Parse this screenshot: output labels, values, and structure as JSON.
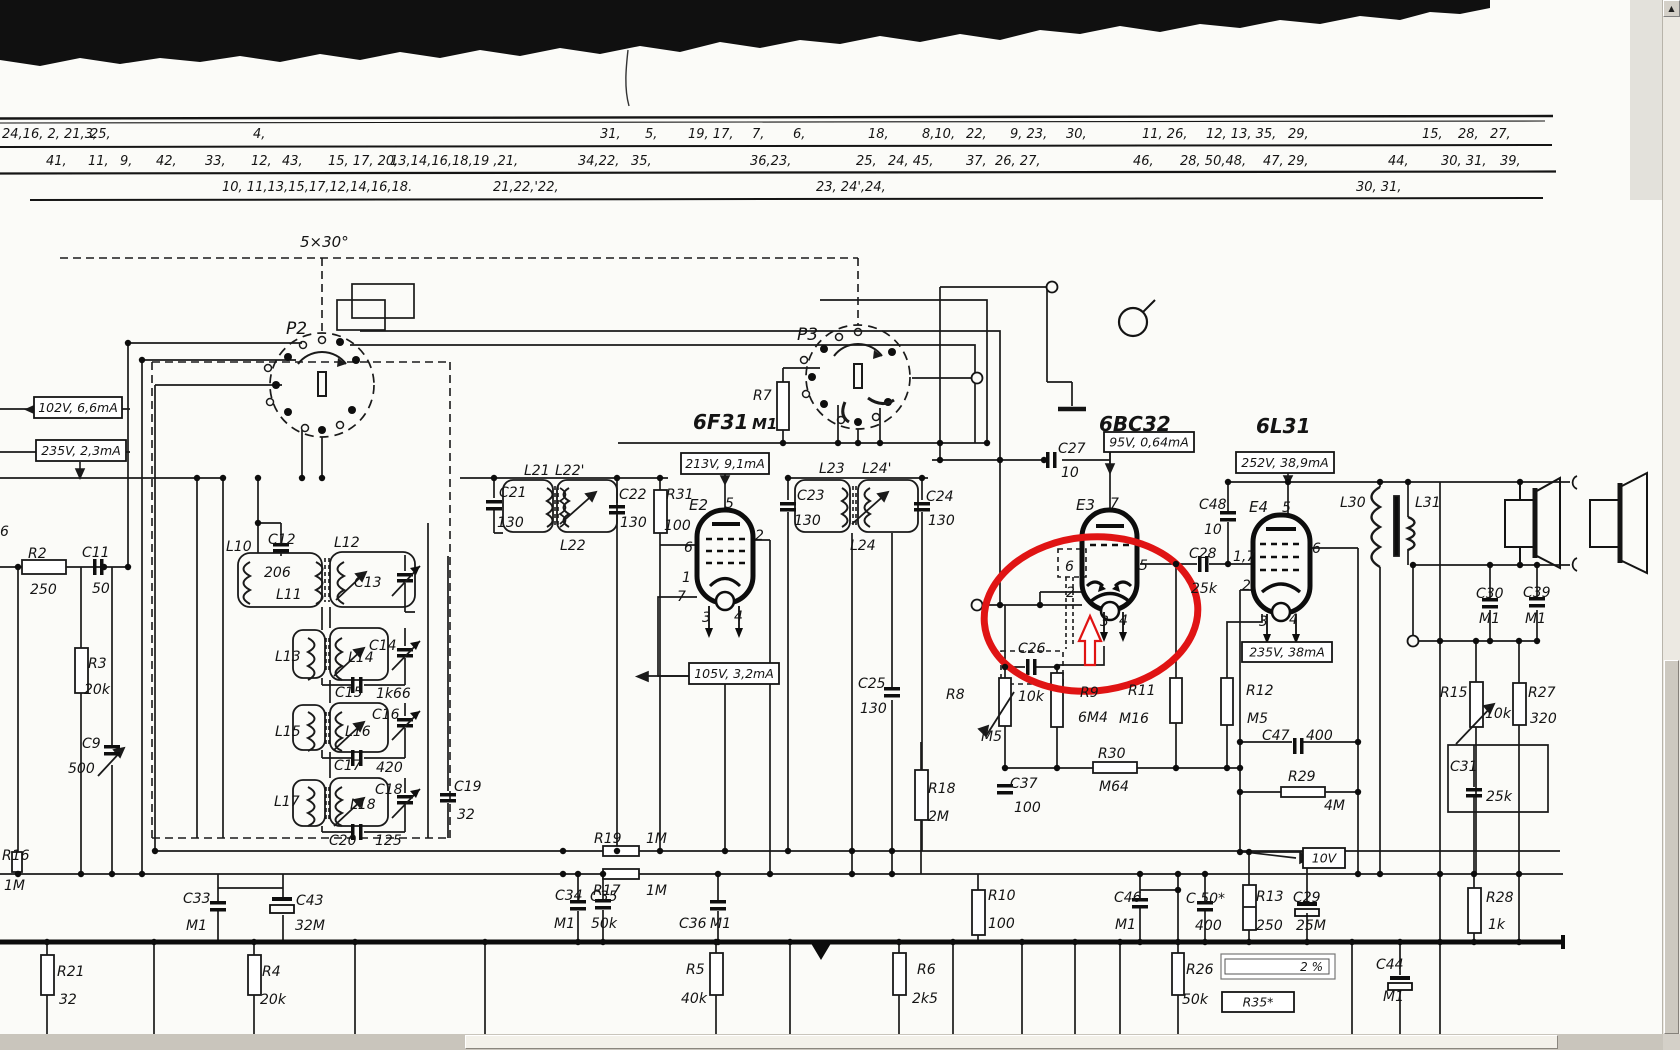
{
  "viewer": {
    "scroll_up_icon": "▲",
    "percent_field": {
      "value": "2 %"
    }
  },
  "annotation": {
    "highlight_color": "#e01414",
    "shapes": [
      "ellipse-around-6BC32-cathode",
      "arrow-up-below-tube"
    ]
  },
  "schematic": {
    "headings": [
      [
        "6F31",
        693,
        429,
        20
      ],
      [
        "M1",
        752,
        429,
        15
      ],
      [
        "6BC32",
        1099,
        431,
        20
      ],
      [
        "6L31",
        1256,
        433,
        20
      ]
    ],
    "boxed_values": [
      [
        "102V, 6,6mA",
        34,
        397,
        88,
        21,
        "v"
      ],
      [
        "235V, 2,3mA",
        36,
        440,
        90,
        21,
        "v"
      ],
      [
        "213V, 9,1mA",
        681,
        453,
        88,
        21,
        "v"
      ],
      [
        "105V, 3,2mA",
        689,
        663,
        90,
        21,
        "v"
      ],
      [
        "95V, 0,64mA",
        1104,
        432,
        90,
        20,
        "v"
      ],
      [
        "252V, 38,9mA",
        1236,
        452,
        98,
        21,
        "v"
      ],
      [
        "235V, 38mA",
        1242,
        642,
        90,
        20,
        "v"
      ],
      [
        "10V",
        1303,
        848,
        42,
        20,
        "v"
      ],
      [
        "R35*",
        1222,
        992,
        72,
        20,
        "plain"
      ],
      [
        "2 %",
        1221,
        954,
        114,
        25,
        "sunken"
      ]
    ],
    "pin_rows": [
      {
        "y": 138,
        "items": [
          [
            2,
            "24,16, 2, 21,3,"
          ],
          [
            90,
            "25,"
          ],
          [
            253,
            "4,"
          ],
          [
            600,
            "31,"
          ],
          [
            645,
            "5,"
          ],
          [
            688,
            "19, 17,"
          ],
          [
            752,
            "7,"
          ],
          [
            793,
            "6,"
          ],
          [
            868,
            "18,"
          ],
          [
            922,
            "8,10,"
          ],
          [
            966,
            "22,"
          ],
          [
            1010,
            "9, 23,"
          ],
          [
            1066,
            "30,"
          ],
          [
            1142,
            "11, 26,"
          ],
          [
            1206,
            "12, 13, 35,"
          ],
          [
            1288,
            "29,"
          ],
          [
            1422,
            "15,"
          ],
          [
            1458,
            "28,"
          ],
          [
            1490,
            "27,"
          ]
        ]
      },
      {
        "y": 165,
        "items": [
          [
            46,
            "41,"
          ],
          [
            88,
            "11,"
          ],
          [
            120,
            "9,"
          ],
          [
            156,
            "42,"
          ],
          [
            205,
            "33,"
          ],
          [
            251,
            "12,"
          ],
          [
            282,
            "43,"
          ],
          [
            328,
            "15, 17, 20,"
          ],
          [
            390,
            "13,14,16,18,19 ,21,"
          ],
          [
            578,
            "34,22,"
          ],
          [
            631,
            "35,"
          ],
          [
            750,
            "36,23,"
          ],
          [
            856,
            "25,"
          ],
          [
            888,
            "24, 45,"
          ],
          [
            966,
            "37,"
          ],
          [
            995,
            "26, 27,"
          ],
          [
            1133,
            "46,"
          ],
          [
            1180,
            "28, 50,48,"
          ],
          [
            1263,
            "47, 29,"
          ],
          [
            1388,
            "44,"
          ],
          [
            1441,
            "30, 31,"
          ],
          [
            1500,
            "39,"
          ]
        ]
      },
      {
        "y": 191,
        "items": [
          [
            222,
            "10, 11,13,15,17,12,14,16,18."
          ],
          [
            493,
            "21,22,'22,"
          ],
          [
            816,
            "23, 24',24,"
          ],
          [
            1356,
            "30, 31,"
          ]
        ]
      }
    ],
    "labels": [
      [
        "6",
        0,
        536
      ],
      [
        "R2",
        28,
        558
      ],
      [
        "250",
        30,
        594
      ],
      [
        "C11",
        82,
        557
      ],
      [
        "50",
        92,
        593
      ],
      [
        "R3",
        88,
        668
      ],
      [
        "20k",
        84,
        694
      ],
      [
        "C9",
        82,
        748
      ],
      [
        "500",
        68,
        773
      ],
      [
        "R16",
        2,
        860
      ],
      [
        "1M",
        4,
        890
      ],
      [
        "R21",
        57,
        976
      ],
      [
        "32",
        59,
        1004
      ],
      [
        "R4",
        262,
        976
      ],
      [
        "20k",
        260,
        1004
      ],
      [
        "C33",
        183,
        903
      ],
      [
        "M1",
        186,
        930
      ],
      [
        "C43",
        296,
        905
      ],
      [
        "32M",
        295,
        930
      ],
      [
        "L10",
        226,
        551
      ],
      [
        "C12",
        268,
        544
      ],
      [
        "206",
        264,
        577
      ],
      [
        "L11",
        276,
        599
      ],
      [
        "L12",
        334,
        547
      ],
      [
        "C13",
        354,
        587
      ],
      [
        "L13",
        275,
        661
      ],
      [
        "L14",
        348,
        662
      ],
      [
        "C14",
        369,
        650
      ],
      [
        "C15",
        335,
        697
      ],
      [
        "1k66",
        376,
        698
      ],
      [
        "L15",
        275,
        736
      ],
      [
        "L16",
        345,
        736
      ],
      [
        "C16",
        372,
        719
      ],
      [
        "C17",
        334,
        770
      ],
      [
        "420",
        376,
        772
      ],
      [
        "L17",
        274,
        806
      ],
      [
        "L18",
        350,
        809
      ],
      [
        "C18",
        375,
        794
      ],
      [
        "C19",
        454,
        791
      ],
      [
        "32",
        457,
        819
      ],
      [
        "C20",
        329,
        845
      ],
      [
        "125",
        375,
        845
      ],
      [
        "5×30°",
        300,
        247,
        15
      ],
      [
        "P2",
        286,
        334,
        17
      ],
      [
        "P3",
        797,
        340,
        17
      ],
      [
        "R7",
        753,
        400
      ],
      [
        "L21",
        524,
        475
      ],
      [
        "L22'",
        555,
        475
      ],
      [
        "C21",
        499,
        497
      ],
      [
        "130",
        497,
        527
      ],
      [
        "C22",
        619,
        499
      ],
      [
        "130",
        620,
        527
      ],
      [
        "L22",
        560,
        550
      ],
      [
        "R31",
        666,
        499
      ],
      [
        "100",
        664,
        530
      ],
      [
        "E2",
        689,
        510,
        15
      ],
      [
        "5",
        725,
        508
      ],
      [
        "2",
        755,
        540
      ],
      [
        "6",
        684,
        552
      ],
      [
        "1",
        682,
        582
      ],
      [
        "7",
        677,
        601
      ],
      [
        "3",
        702,
        622
      ],
      [
        "4",
        734,
        621
      ],
      [
        "L23",
        819,
        473
      ],
      [
        "L24'",
        862,
        473
      ],
      [
        "C23",
        797,
        500
      ],
      [
        "130",
        794,
        525
      ],
      [
        "C24",
        926,
        501
      ],
      [
        "130",
        928,
        525
      ],
      [
        "L24",
        850,
        550
      ],
      [
        "C27",
        1058,
        453
      ],
      [
        "10",
        1061,
        477
      ],
      [
        "E3",
        1076,
        510,
        15
      ],
      [
        "7",
        1110,
        508
      ],
      [
        "6",
        1065,
        571
      ],
      [
        "2",
        1066,
        597
      ],
      [
        "5",
        1139,
        570
      ],
      [
        "3",
        1100,
        626
      ],
      [
        "4",
        1119,
        625
      ],
      [
        "C26",
        1018,
        653
      ],
      [
        "10k",
        1018,
        701
      ],
      [
        "R8",
        946,
        699
      ],
      [
        "M5",
        981,
        741
      ],
      [
        "R9",
        1080,
        697
      ],
      [
        "6M4",
        1078,
        722
      ],
      [
        "R11",
        1128,
        695
      ],
      [
        "M16",
        1119,
        723
      ],
      [
        "C25",
        858,
        688
      ],
      [
        "130",
        860,
        713
      ],
      [
        "R18",
        928,
        793
      ],
      [
        "2M",
        928,
        821
      ],
      [
        "C37",
        1010,
        788
      ],
      [
        "100",
        1014,
        812
      ],
      [
        "R30",
        1098,
        758
      ],
      [
        "M64",
        1099,
        791
      ],
      [
        "C48",
        1199,
        509
      ],
      [
        "10",
        1204,
        534
      ],
      [
        "C28",
        1189,
        558
      ],
      [
        "25k",
        1191,
        593
      ],
      [
        "1,7",
        1233,
        561
      ],
      [
        "E4",
        1249,
        512,
        15
      ],
      [
        "5",
        1282,
        512
      ],
      [
        "6",
        1312,
        553
      ],
      [
        "2",
        1242,
        590
      ],
      [
        "3",
        1259,
        626
      ],
      [
        "4",
        1289,
        624
      ],
      [
        "R12",
        1246,
        695
      ],
      [
        "M5",
        1247,
        723
      ],
      [
        "C47",
        1262,
        740
      ],
      [
        "400",
        1306,
        740
      ],
      [
        "R29",
        1288,
        781
      ],
      [
        "4M",
        1324,
        810
      ],
      [
        "R10",
        988,
        900
      ],
      [
        "100",
        988,
        928
      ],
      [
        "L30",
        1340,
        507
      ],
      [
        "L31",
        1415,
        507
      ],
      [
        "C30",
        1476,
        598
      ],
      [
        "M1",
        1479,
        623
      ],
      [
        "C39",
        1523,
        597
      ],
      [
        "M1",
        1525,
        623
      ],
      [
        "R15",
        1440,
        697
      ],
      [
        "10k",
        1485,
        718
      ],
      [
        "R27",
        1528,
        697
      ],
      [
        "320",
        1530,
        723
      ],
      [
        "C31",
        1450,
        771
      ],
      [
        "25k",
        1486,
        801
      ],
      [
        "R28",
        1486,
        902
      ],
      [
        "1k",
        1488,
        929
      ],
      [
        "R19",
        594,
        843
      ],
      [
        "1M",
        646,
        843
      ],
      [
        "R17",
        593,
        895
      ],
      [
        "1M",
        646,
        895
      ],
      [
        "C34",
        555,
        900
      ],
      [
        "M1",
        554,
        928
      ],
      [
        "C35",
        590,
        901
      ],
      [
        "50k",
        591,
        928
      ],
      [
        "C36",
        679,
        928
      ],
      [
        "M1",
        710,
        928
      ],
      [
        "C46",
        1114,
        902
      ],
      [
        "M1",
        1115,
        929
      ],
      [
        "C 50*",
        1186,
        903
      ],
      [
        "400",
        1195,
        930
      ],
      [
        "R13",
        1256,
        901
      ],
      [
        "250",
        1256,
        930
      ],
      [
        "C29",
        1293,
        902
      ],
      [
        "25M",
        1296,
        930
      ],
      [
        "R26",
        1186,
        974
      ],
      [
        "50k",
        1182,
        1004
      ],
      [
        "R5",
        686,
        974
      ],
      [
        "40k",
        681,
        1003
      ],
      [
        "R6",
        917,
        974
      ],
      [
        "2k5",
        912,
        1003
      ],
      [
        "C44",
        1376,
        969
      ],
      [
        "M1",
        1383,
        1001
      ]
    ]
  }
}
